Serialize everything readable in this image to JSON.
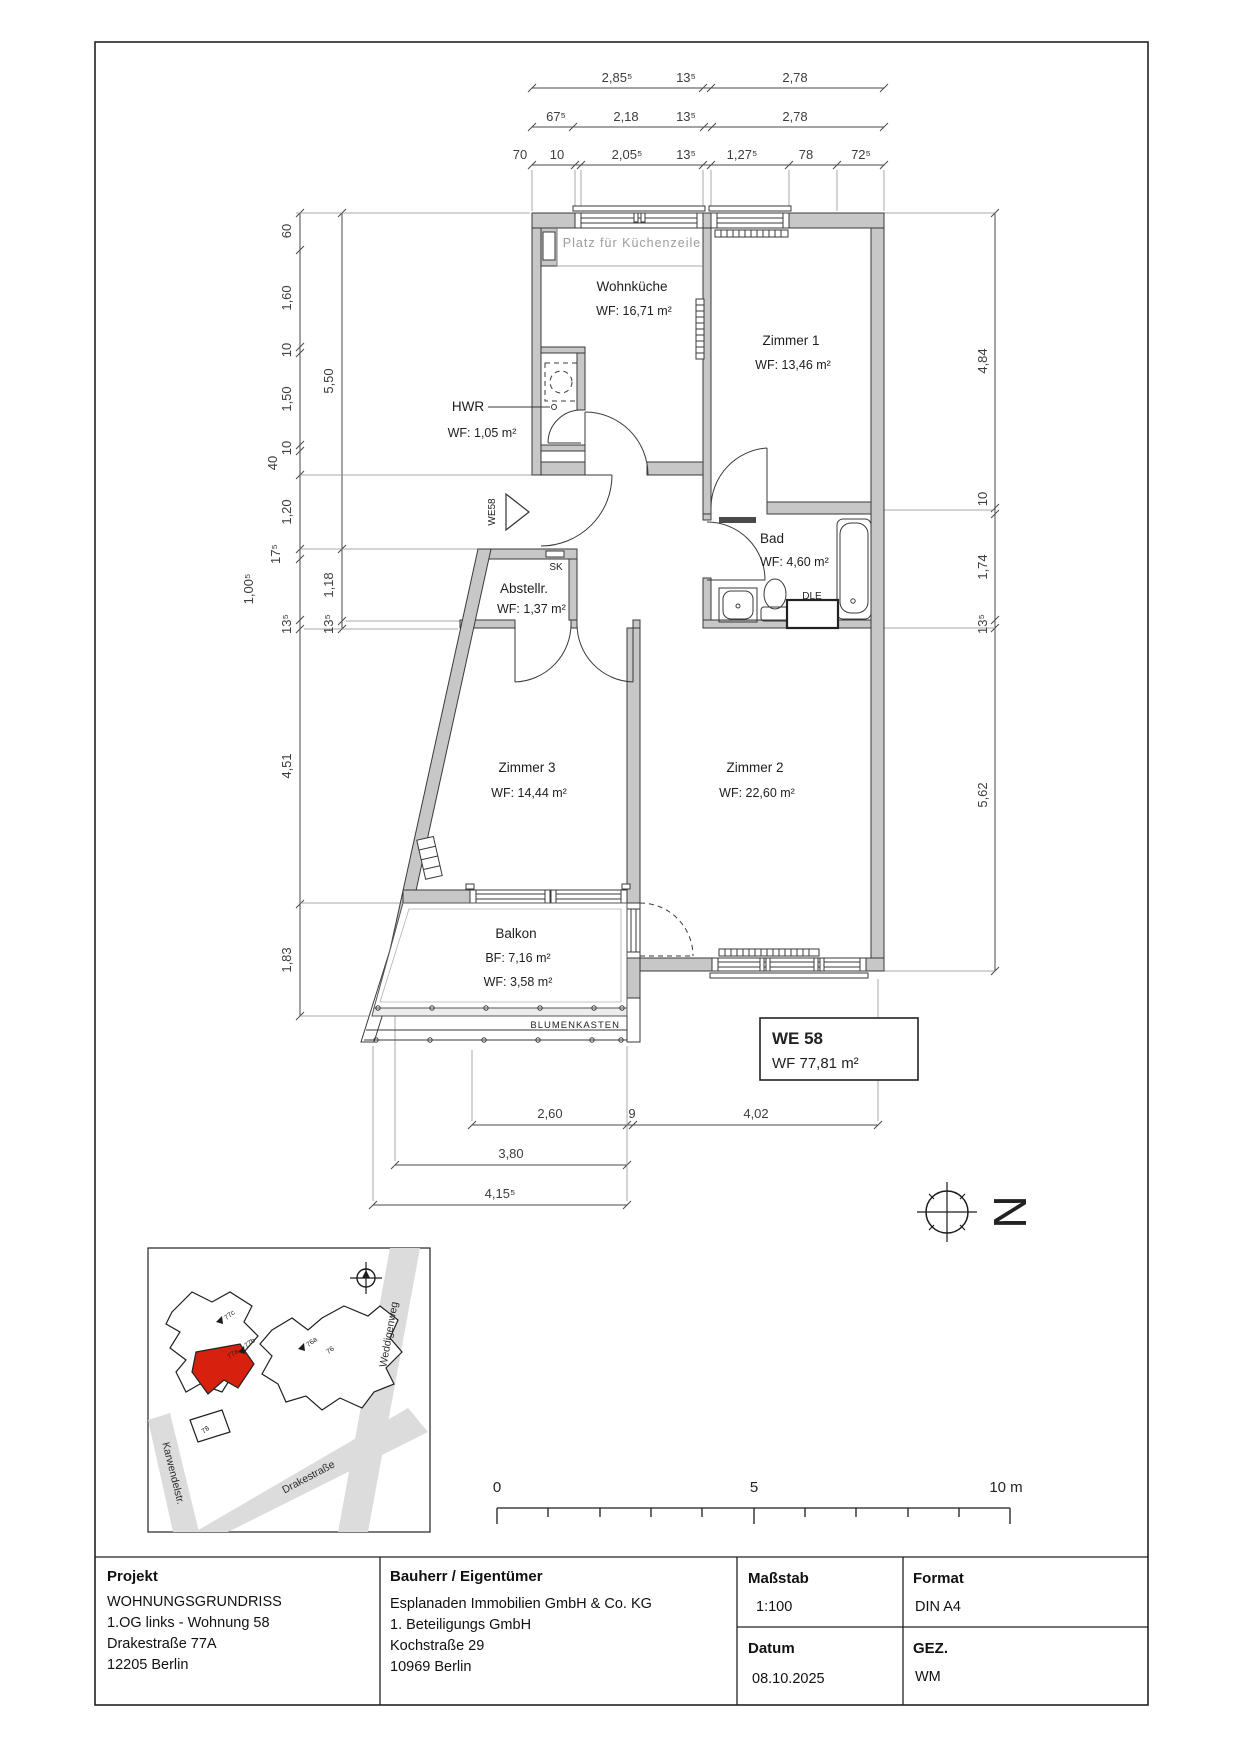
{
  "rooms": {
    "wohnkueche": {
      "name": "Wohnküche",
      "area": "WF: 16,71 m²"
    },
    "zimmer1": {
      "name": "Zimmer 1",
      "area": "WF: 13,46 m²"
    },
    "zimmer2": {
      "name": "Zimmer 2",
      "area": "WF: 22,60 m²"
    },
    "zimmer3": {
      "name": "Zimmer 3",
      "area": "WF: 14,44 m²"
    },
    "bad": {
      "name": "Bad",
      "area": "WF: 4,60 m²"
    },
    "hwr": {
      "name": "HWR",
      "area": "WF: 1,05 m²"
    },
    "abstellraum": {
      "name": "Abstellr.",
      "area": "WF: 1,37 m²"
    },
    "balkon": {
      "name": "Balkon",
      "bf": "BF: 7,16 m²",
      "area": "WF: 3,58 m²"
    }
  },
  "annotations": {
    "kueche_hint": "Platz für Küchenzeile",
    "entry": "WE58",
    "sk": "SK",
    "dle": "DLE",
    "blumenkasten": "BLUMENKASTEN",
    "north": "N"
  },
  "unit_box": {
    "id": "WE 58",
    "area": "WF 77,81 m²"
  },
  "dims": {
    "top1": [
      "2,85⁵",
      "13⁵",
      "2,78"
    ],
    "top2": [
      "67⁵",
      "2,18",
      "13⁵",
      "2,78"
    ],
    "top3": [
      "70",
      "10",
      "2,05⁵",
      "13⁵",
      "1,27⁵",
      "78",
      "72⁵"
    ],
    "left_inner": [
      "60",
      "1,60",
      "10",
      "1,50",
      "10",
      "40",
      "1,20",
      "17⁵",
      "1,00⁵",
      "13⁵",
      "4,51",
      "1,83"
    ],
    "left_outer": [
      "5,50",
      "1,18",
      "13⁵"
    ],
    "right": [
      "4,84",
      "10",
      "1,74",
      "13⁵",
      "5,62"
    ],
    "bottom1": [
      "2,60",
      "9",
      "4,02"
    ],
    "bottom2": [
      "3,80"
    ],
    "bottom3": [
      "4,15⁵"
    ]
  },
  "scalebar": {
    "start": "0",
    "mid": "5",
    "end": "10 m"
  },
  "site_map": {
    "streets": [
      "Weddigenweg",
      "Drakestraße",
      "Karwendelstr."
    ],
    "buildings": [
      "77c",
      "77b",
      "77a",
      "76a",
      "76",
      "78"
    ],
    "highlight_color": "#d8200f"
  },
  "title_block": {
    "projekt_label": "Projekt",
    "projekt_lines": [
      "WOHNUNGSGRUNDRISS",
      "1.OG links - Wohnung 58",
      "Drakestraße 77A",
      "12205 Berlin"
    ],
    "bauherr_label": "Bauherr / Eigentümer",
    "bauherr_lines": [
      "Esplanaden Immobilien GmbH & Co. KG",
      "1. Beteiligungs GmbH",
      "Kochstraße 29",
      "10969 Berlin"
    ],
    "massstab_label": "Maßstab",
    "massstab_value": "1:100",
    "format_label": "Format",
    "format_value": "DIN A4",
    "datum_label": "Datum",
    "datum_value": "08.10.2025",
    "gez_label": "GEZ.",
    "gez_value": "WM"
  },
  "colors": {
    "wall": "#c7c7c7",
    "line": "#3a3a3a",
    "dim": "#4a4a4a",
    "muted": "#9c9c9c"
  }
}
